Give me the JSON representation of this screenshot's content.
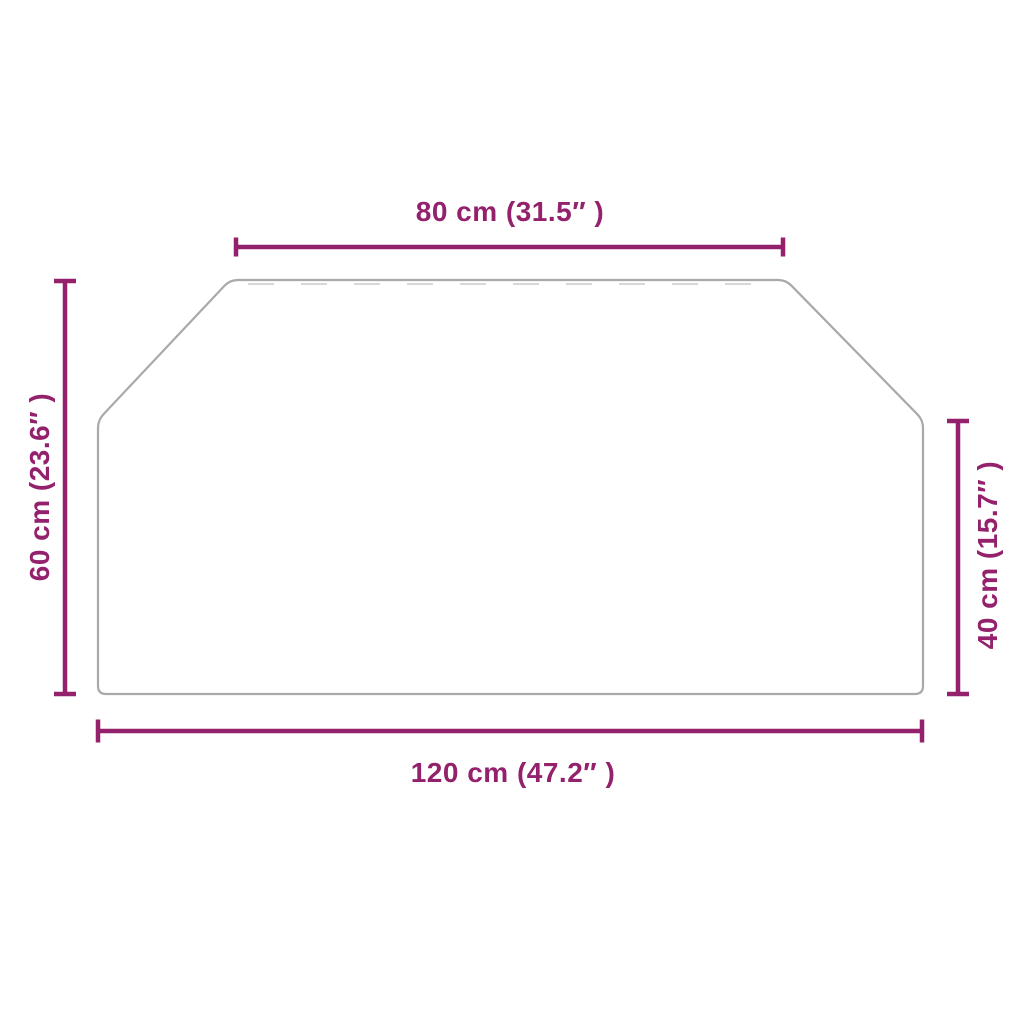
{
  "shape": "hexagon",
  "colors": {
    "background": "#ffffff",
    "dimension": "#93216c",
    "outline": "#a9a9a9",
    "hinge_dash": "#d8d8d8"
  },
  "dimensions": {
    "top": {
      "label": "80 cm (31.5″ )",
      "cm": 80,
      "inches": 31.5
    },
    "left": {
      "label": "60 cm (23.6″ )",
      "cm": 60,
      "inches": 23.6
    },
    "right": {
      "label": "40 cm (15.7″ )",
      "cm": 40,
      "inches": 15.7
    },
    "bottom": {
      "label": "120 cm (47.2″ )",
      "cm": 120,
      "inches": 47.2
    }
  }
}
